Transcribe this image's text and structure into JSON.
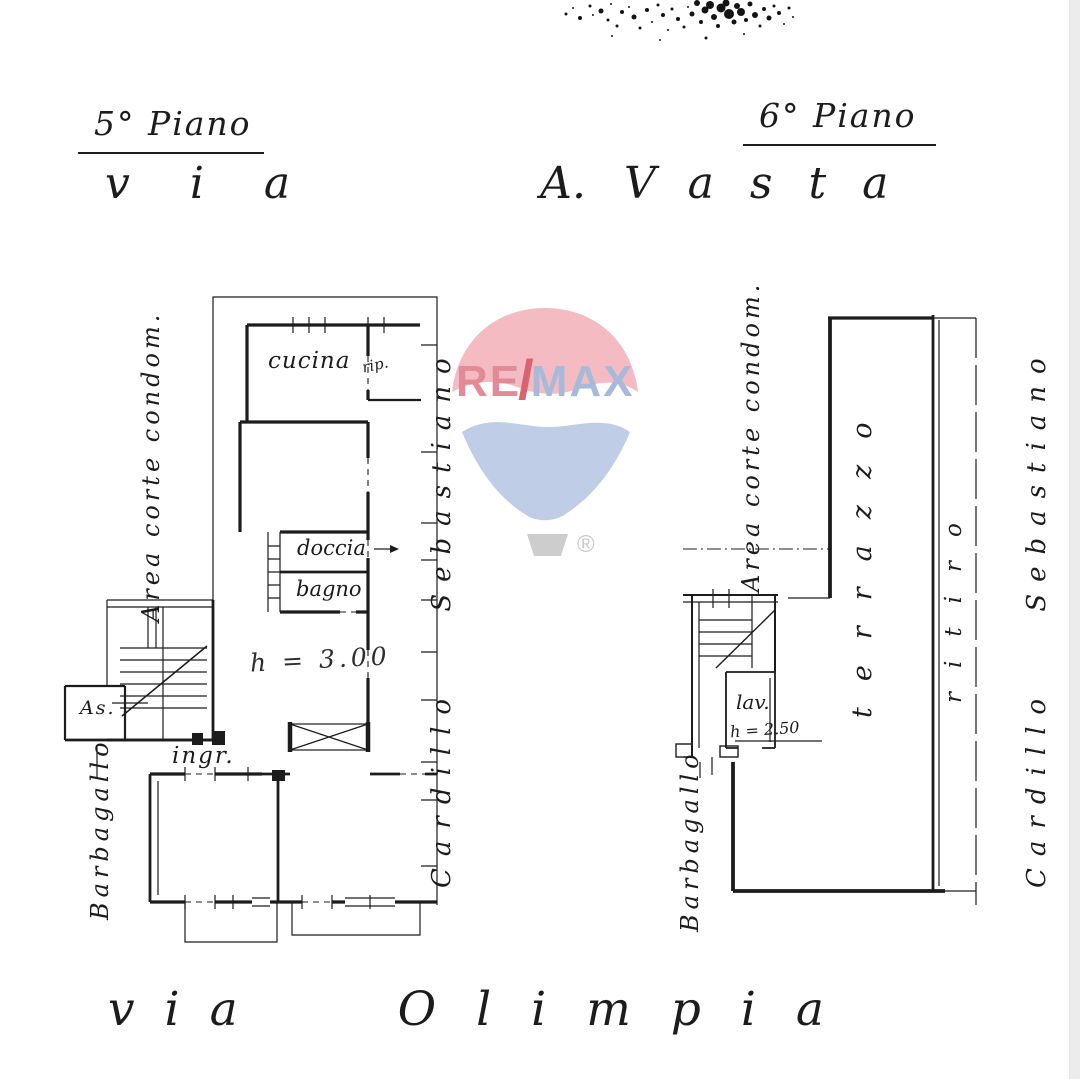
{
  "watermark": {
    "re": "RE",
    "slash": "/",
    "max": "MAX",
    "registered": "®"
  },
  "streets": {
    "top": [
      "via",
      "A.",
      "Vasta"
    ],
    "bottom": [
      "via",
      "Olimpia"
    ]
  },
  "plans": {
    "fifth": {
      "title": "5° Piano",
      "rooms": {
        "cucina": "cucina",
        "ripostiglio": "rip.",
        "doccia": "doccia",
        "bagno": "bagno",
        "ceiling_height": "h = 3.00",
        "ingresso": "ingr.",
        "ascensore": "As."
      },
      "side_labels": {
        "area_corte": "Area corte condom.",
        "barbagallo": "Barbagallo",
        "cardillo_sebastiano": "Cardillo  Sebastiano"
      }
    },
    "sixth": {
      "title": "6° Piano",
      "rooms": {
        "lavanderia": "lav.",
        "ceiling_height": "h = 2.50",
        "terrazzo": "terrazzo",
        "ritiro": "ritiro"
      },
      "side_labels": {
        "area_corte": "Area corte condom.",
        "barbagallo": "Barbagallo",
        "cardillo_sebastiano": "Cardillo  Sebastiano"
      }
    }
  },
  "colors": {
    "ink": "#1c1c1c",
    "paper": "#ffffff",
    "remax_canopy": "#f4bcc2",
    "remax_cone": "#bfcde6",
    "remax_red_text": "#e18b97",
    "remax_slash": "#da636f",
    "remax_blue_text": "#a7bad9",
    "remax_basket": "#cdcdcd"
  }
}
